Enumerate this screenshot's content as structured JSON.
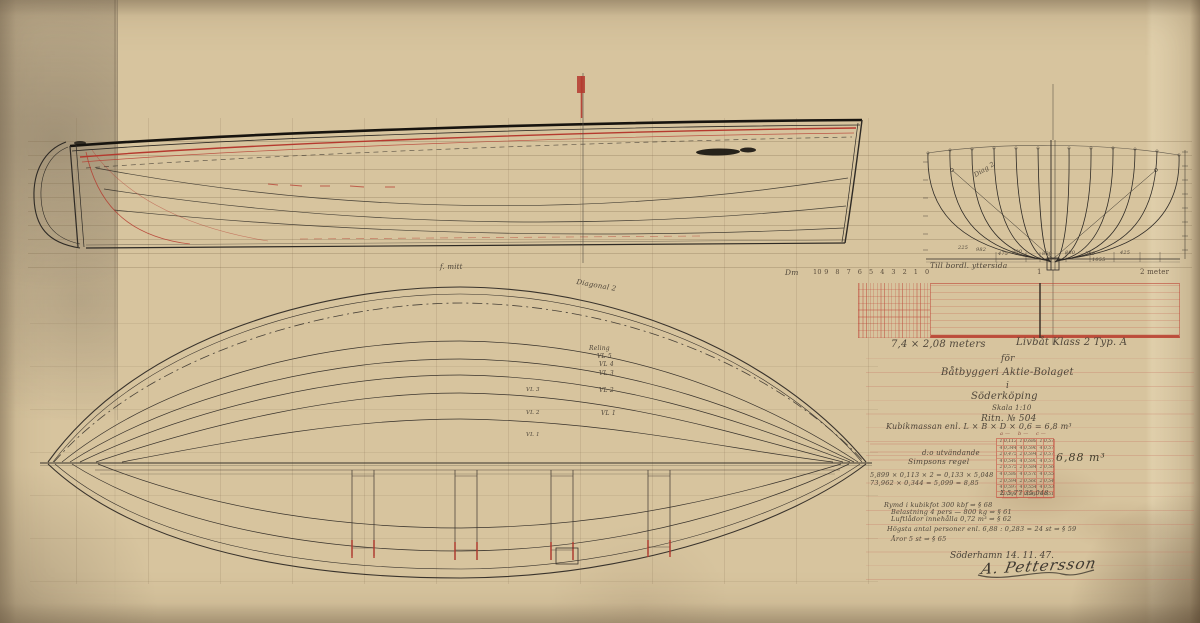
{
  "palette": {
    "paper": "#d7c49e",
    "ink": "#2e2a25",
    "red": "#b5392e",
    "pencil": "#4f463a"
  },
  "signoff": {
    "place_date": "Söderhamn 14. 11. 47.",
    "signature": "A. Pettersson"
  },
  "calculations": {
    "result": "6,88 m³",
    "table": {
      "rows": [
        [
          "1",
          "0,113",
          "1",
          "0,688",
          "1",
          "0,574"
        ],
        [
          "4",
          "0,344",
          "4",
          "0,596",
          "4",
          "0,578"
        ],
        [
          "2",
          "0,475",
          "2",
          "0,594",
          "2",
          "0,576"
        ],
        [
          "4",
          "0,548",
          "4",
          "0,590",
          "4",
          "0,572"
        ],
        [
          "2",
          "0,575",
          "2",
          "0,584",
          "2",
          "0,566"
        ],
        [
          "4",
          "0,588",
          "4",
          "0,576",
          "4",
          "0,558"
        ],
        [
          "2",
          "0,594",
          "2",
          "0,566",
          "2",
          "0,546"
        ],
        [
          "4",
          "0,597",
          "4",
          "0,554",
          "4",
          "0,532"
        ],
        [
          "1",
          "0,598",
          "1",
          "0,540",
          "1",
          "0,516"
        ]
      ]
    }
  },
  "scale_bar": {
    "unit_label": "Dm",
    "dm_ticks": [
      "10",
      "9",
      "8",
      "7",
      "6",
      "5",
      "4",
      "3",
      "2",
      "1",
      "0"
    ],
    "meter_labels": [
      {
        "name": "scale-meter-1",
        "text": "1",
        "x": 1037
      },
      {
        "name": "scale-meter-2",
        "text": "2 meter",
        "x": 1140
      }
    ]
  },
  "annotations": {
    "title_block": [
      {
        "name": "title-dimensions",
        "text": "7,4 × 2,08 meters",
        "x": 891,
        "y": 340,
        "size": 10
      },
      {
        "name": "title-type",
        "text": "Livbåt Klass 2 Typ. A",
        "x": 1016,
        "y": 338,
        "size": 10
      },
      {
        "name": "title-for",
        "text": "för",
        "x": 1001,
        "y": 355,
        "size": 9
      },
      {
        "name": "title-company",
        "text": "Båtbyggeri Aktie-Bolaget",
        "x": 941,
        "y": 368,
        "size": 10
      },
      {
        "name": "title-in",
        "text": "i",
        "x": 1006,
        "y": 382,
        "size": 9
      },
      {
        "name": "title-city",
        "text": "Söderköping",
        "x": 971,
        "y": 392,
        "size": 10
      },
      {
        "name": "title-scale",
        "text": "Skala 1:10",
        "x": 992,
        "y": 405,
        "size": 7
      },
      {
        "name": "drawing-number",
        "text": "Ritn. № 504",
        "x": 981,
        "y": 415,
        "size": 9
      }
    ],
    "calculation_notes": [
      {
        "name": "formula-line",
        "text": "Kubikmassan enl. L × B × D × 0,6 = 6,8 m³",
        "x": 886,
        "y": 423,
        "size": 8
      },
      {
        "name": "row-outside",
        "text": "d:o utvändande",
        "x": 922,
        "y": 450,
        "size": 7
      },
      {
        "name": "row-simpson",
        "text": "Simpsons regel",
        "x": 908,
        "y": 458,
        "size": 7.5
      },
      {
        "name": "calc-line-1",
        "text": "5,899 × 0,113 × 2 = 0,133 × 5,048",
        "x": 870,
        "y": 472,
        "size": 6.5
      },
      {
        "name": "calc-line-2",
        "text": "73,962 × 0,344 = 5,099 = 8,85",
        "x": 870,
        "y": 480,
        "size": 6.5
      },
      {
        "name": "calc-sum",
        "text": "Σ 5,77   35,048",
        "x": 1000,
        "y": 490,
        "size": 6.5
      },
      {
        "name": "table-header-a",
        "text": "a —",
        "x": 1000,
        "y": 432,
        "size": 5,
        "color": "#8a4a3e"
      },
      {
        "name": "table-header-b",
        "text": "b —",
        "x": 1018,
        "y": 432,
        "size": 5,
        "color": "#8a4a3e"
      },
      {
        "name": "table-header-c",
        "text": "c —",
        "x": 1036,
        "y": 432,
        "size": 5,
        "color": "#8a4a3e"
      }
    ],
    "specs": [
      {
        "name": "spec-volume",
        "text": "Rymd i kubikfot 300 kbf ⇒ § 68",
        "x": 884,
        "y": 502,
        "size": 6.5
      },
      {
        "name": "spec-load",
        "text": "Belastning 4 pers — 800 kg ⇒ § 61",
        "x": 891,
        "y": 509,
        "size": 6.5
      },
      {
        "name": "spec-airtanks",
        "text": "Luftlådor innehålla 0,72 m³ ⇒ § 62",
        "x": 891,
        "y": 516,
        "size": 6.5
      },
      {
        "name": "spec-persons",
        "text": "Högsta antal personer enl. 6,88 : 0,283 = 24 st ⇒ § 59",
        "x": 887,
        "y": 526,
        "size": 6.5
      },
      {
        "name": "spec-oars",
        "text": "Åror 5 st ⇒ § 65",
        "x": 891,
        "y": 536,
        "size": 6.5
      }
    ],
    "plan_view_labels": [
      {
        "name": "label-midship",
        "text": "f. mitt",
        "x": 440,
        "y": 264,
        "size": 7
      },
      {
        "name": "label-diagonal",
        "text": "Diagonal 2",
        "x": 577,
        "y": 279,
        "size": 7,
        "rotate": 10
      },
      {
        "name": "label-reling",
        "text": "Reling",
        "x": 589,
        "y": 346,
        "size": 6
      },
      {
        "name": "label-vl5",
        "text": "VL 5",
        "x": 597,
        "y": 354,
        "size": 6
      },
      {
        "name": "label-vl4",
        "text": "VL 4",
        "x": 599,
        "y": 362,
        "size": 6
      },
      {
        "name": "label-vl3",
        "text": "VL 3",
        "x": 599,
        "y": 371,
        "size": 6
      },
      {
        "name": "label-vl2",
        "text": "VL 2",
        "x": 599,
        "y": 388,
        "size": 6
      },
      {
        "name": "label-vl1",
        "text": "VL 1",
        "x": 601,
        "y": 411,
        "size": 6
      },
      {
        "name": "label-vl3-left",
        "text": "VL 3",
        "x": 526,
        "y": 388,
        "size": 5.5
      },
      {
        "name": "label-vl2-left",
        "text": "VL 2",
        "x": 526,
        "y": 411,
        "size": 5.5
      },
      {
        "name": "label-vl1-left",
        "text": "VL 1",
        "x": 526,
        "y": 433,
        "size": 5.5
      }
    ],
    "body_plan_labels": [
      {
        "name": "note-planking",
        "text": "Till bordl. yttersida",
        "x": 930,
        "y": 262,
        "size": 7.5
      },
      {
        "name": "label-diag2",
        "text": "Diag 2",
        "x": 973,
        "y": 173,
        "size": 6.5,
        "rotate": -32
      },
      {
        "name": "dim-225",
        "text": "225",
        "x": 958,
        "y": 246,
        "size": 5
      },
      {
        "name": "dim-982",
        "text": "982",
        "x": 976,
        "y": 248,
        "size": 5
      },
      {
        "name": "dim-475",
        "text": "475",
        "x": 998,
        "y": 252,
        "size": 5
      },
      {
        "name": "dim-300",
        "text": "300",
        "x": 1012,
        "y": 250,
        "size": 5
      },
      {
        "name": "dim-800a",
        "text": "800",
        "x": 1042,
        "y": 252,
        "size": 5
      },
      {
        "name": "dim-800b",
        "text": "800",
        "x": 1065,
        "y": 251,
        "size": 5
      },
      {
        "name": "dim-500",
        "text": "500",
        "x": 1085,
        "y": 252,
        "size": 5
      },
      {
        "name": "dim-1055",
        "text": "1055",
        "x": 1092,
        "y": 258,
        "size": 5
      },
      {
        "name": "dim-425",
        "text": "425",
        "x": 1120,
        "y": 251,
        "size": 5
      }
    ],
    "scale_labels": [
      {
        "name": "scale-unit",
        "text": "Dm",
        "x": 785,
        "y": 269,
        "size": 7.5
      }
    ]
  }
}
